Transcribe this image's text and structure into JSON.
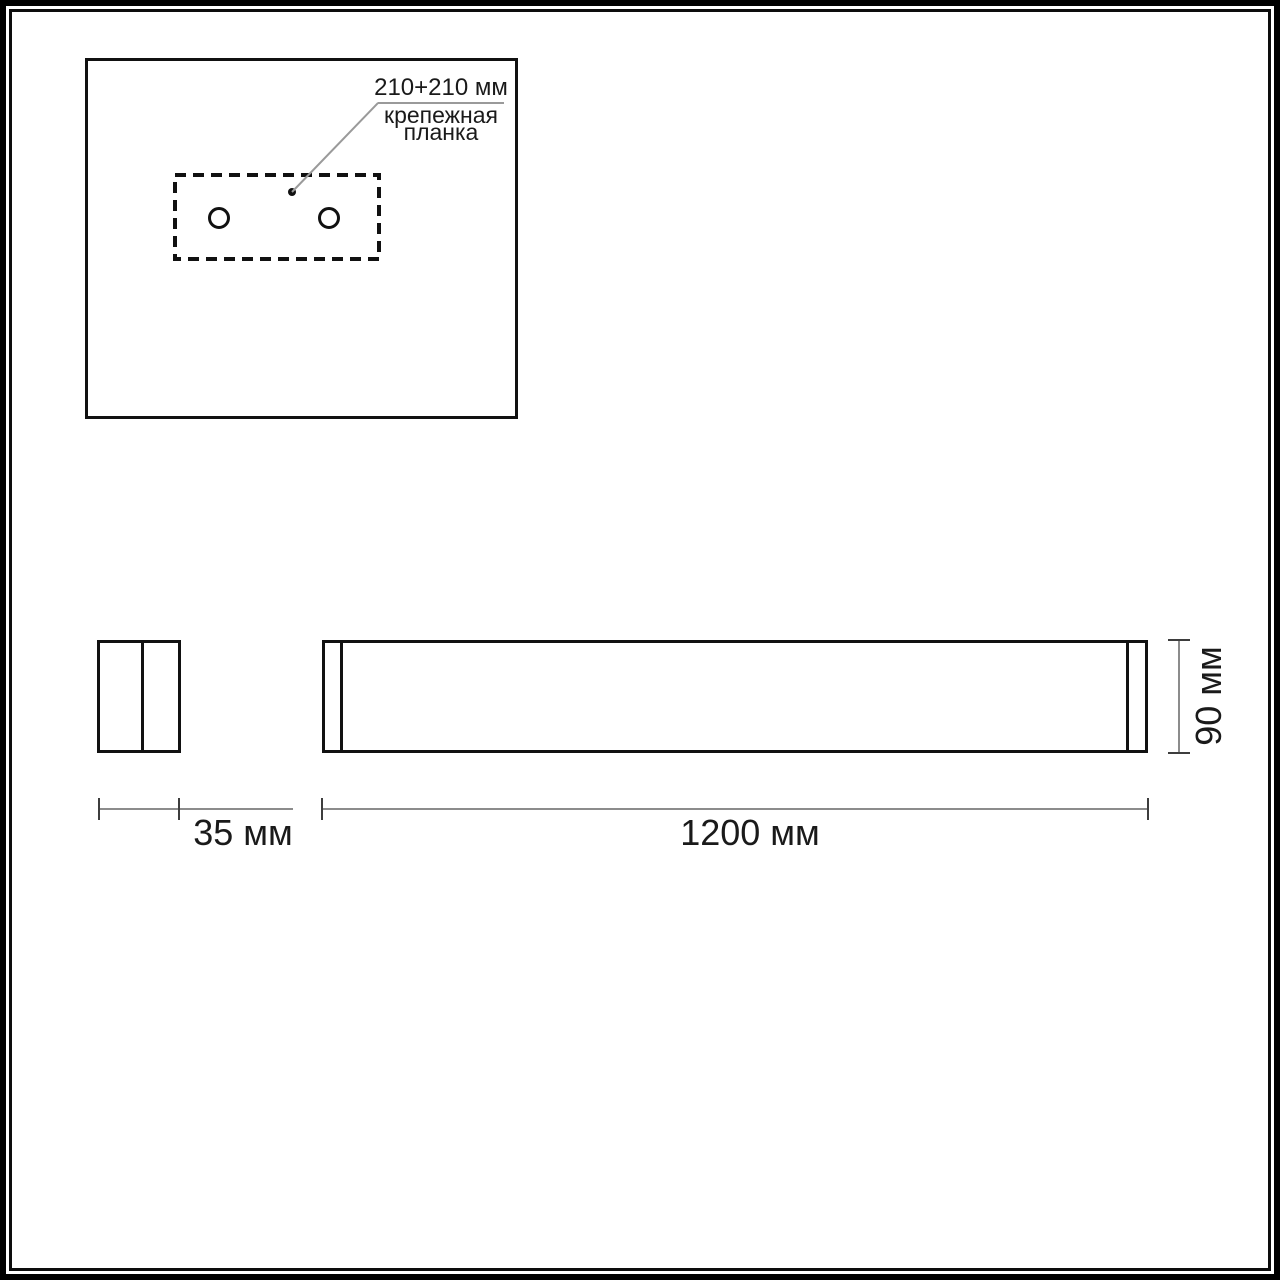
{
  "drawing": {
    "mounting_view": {
      "spacing_label": "210+210 мм",
      "bracket_label": "крепежная планка",
      "hole_count": 2
    },
    "side_view": {
      "depth_label": "35 мм",
      "depth_mm": 35
    },
    "front_view": {
      "length_label": "1200 мм",
      "length_mm": 1200,
      "height_label": "90 мм",
      "height_mm": 90
    }
  },
  "colors": {
    "background": "#ffffff",
    "outline_black": "#111111",
    "dimension_line_gray": "#8c8c8c",
    "tick_dark": "#3d3d3d",
    "text": "#1a1a1a"
  }
}
